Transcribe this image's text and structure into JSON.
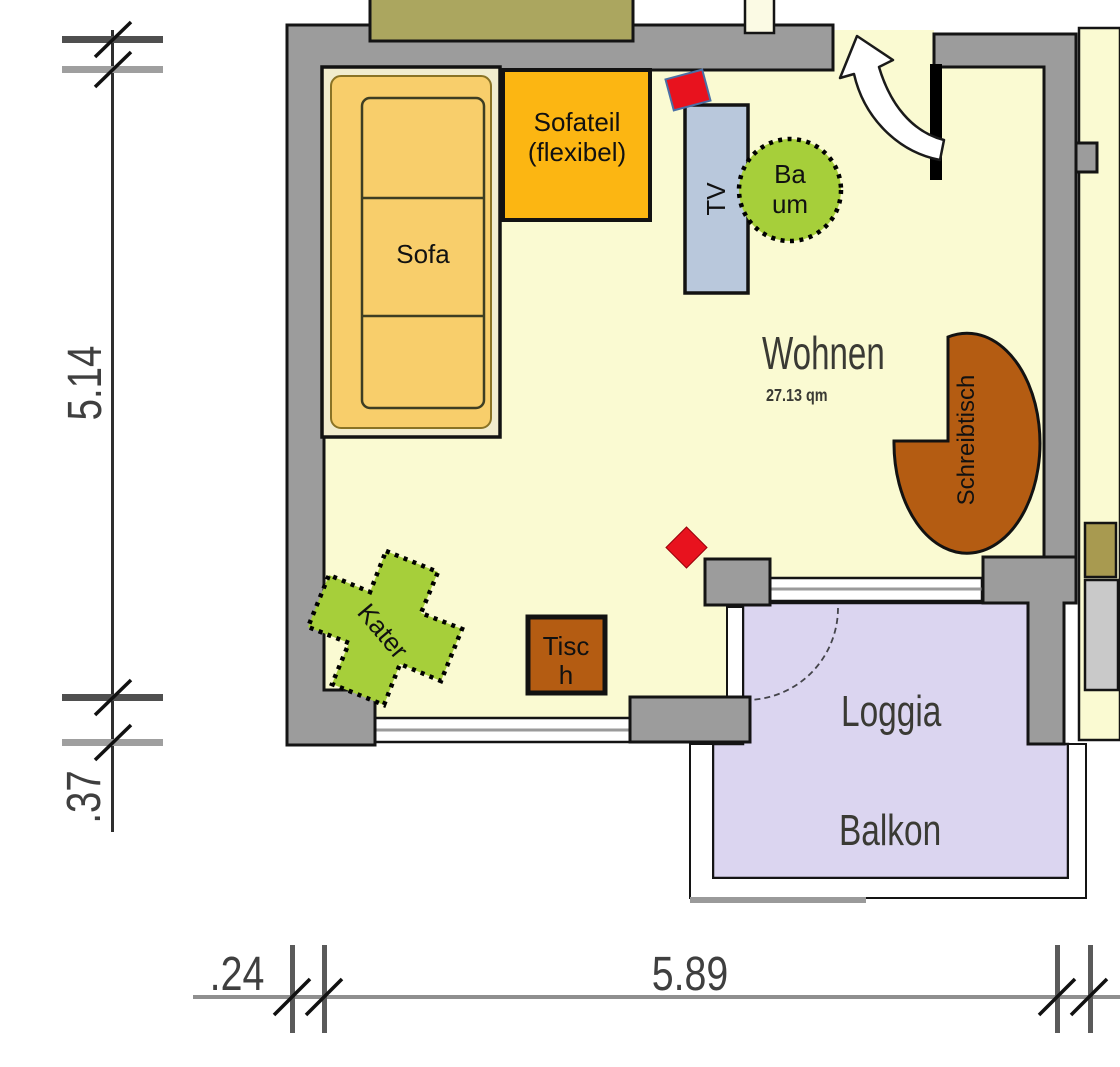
{
  "plan": {
    "rooms": {
      "wohnen": {
        "name": "Wohnen",
        "area": "27.13 qm"
      },
      "loggia": {
        "line1": "Loggia",
        "line2": "Balkon"
      }
    },
    "furniture": {
      "sofa": "Sofa",
      "sofateil_line1": "Sofateil",
      "sofateil_line2": "(flexibel)",
      "tv": "TV",
      "baum_line1": "Ba",
      "baum_line2": "um",
      "kater": "Kater",
      "tisch_line1": "Tisc",
      "tisch_line2": "h",
      "schreibtisch": "Schreibtisch"
    },
    "dimensions": {
      "left_height": "5.14",
      "left_lower": ".37",
      "bottom_wall": ".24",
      "bottom_width": "5.89"
    },
    "colors": {
      "floor": "#FAFAD2",
      "wall": "#9C9C9C",
      "outline": "#141414",
      "balcony": "#DBD5F0",
      "sofa_box": "#F1ECCE",
      "sofa_body": "#F8CE6B",
      "sofateil_orange": "#FCB612",
      "tv_blue": "#B9C8DC",
      "plant_green": "#A6CF3A",
      "wood_brown": "#B45C12",
      "marker_red": "#E8121E",
      "khaki": "#ABA65F"
    }
  }
}
